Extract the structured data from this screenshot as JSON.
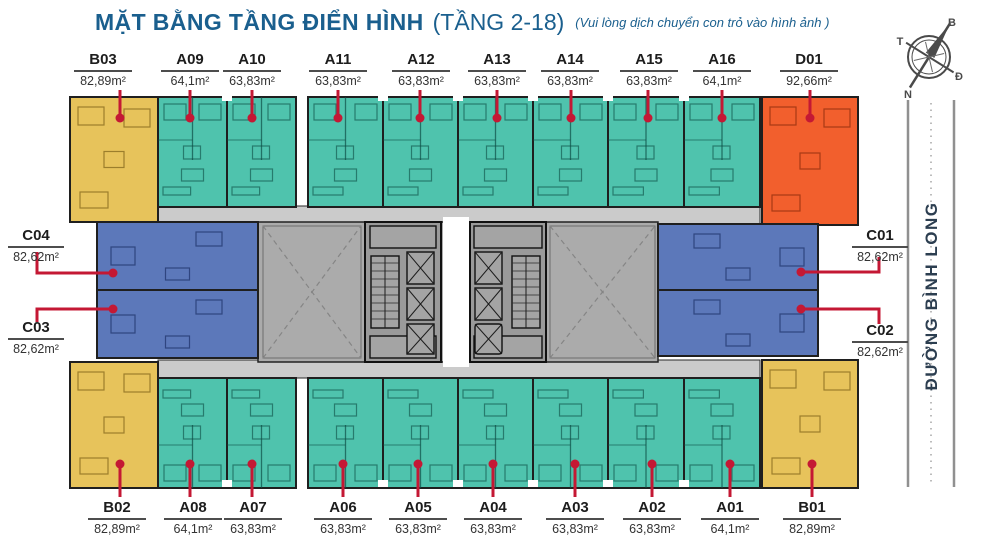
{
  "page": {
    "title": "MẶT BẰNG TẦNG ĐIỂN HÌNH",
    "title_suffix": "(TẦNG 2-18)",
    "note": "(Vui lòng dịch chuyển con trỏ vào hình ảnh )"
  },
  "street": {
    "name": "ĐƯỜNG BÌNH LONG"
  },
  "compass": {
    "north": "B",
    "south": "N",
    "east": "Đ",
    "west": "T"
  },
  "legend_colors": {
    "type_a": "#4FC3AD",
    "type_b": "#E7C35B",
    "type_c": "#5C78BA",
    "type_d": "#F25F2D",
    "corridor": "#CBCBCB",
    "core": "#9A9A9A",
    "void": "#ABABAB",
    "callout_red": "#C41834",
    "title_blue": "#1A5F8E",
    "street_text": "#2C3E50",
    "wall": "#1F1F1F"
  },
  "units": [
    {
      "id": "B03",
      "area": "82,89m²"
    },
    {
      "id": "A09",
      "area": "64,1m²"
    },
    {
      "id": "A10",
      "area": "63,83m²"
    },
    {
      "id": "A11",
      "area": "63,83m²"
    },
    {
      "id": "A12",
      "area": "63,83m²"
    },
    {
      "id": "A13",
      "area": "63,83m²"
    },
    {
      "id": "A14",
      "area": "63,83m²"
    },
    {
      "id": "A15",
      "area": "63,83m²"
    },
    {
      "id": "A16",
      "area": "64,1m²"
    },
    {
      "id": "D01",
      "area": "92,66m²"
    },
    {
      "id": "C04",
      "area": "82,62m²"
    },
    {
      "id": "C03",
      "area": "82,62m²"
    },
    {
      "id": "C01",
      "area": "82,62m²"
    },
    {
      "id": "C02",
      "area": "82,62m²"
    },
    {
      "id": "B02",
      "area": "82,89m²"
    },
    {
      "id": "A08",
      "area": "64,1m²"
    },
    {
      "id": "A07",
      "area": "63,83m²"
    },
    {
      "id": "A06",
      "area": "63,83m²"
    },
    {
      "id": "A05",
      "area": "63,83m²"
    },
    {
      "id": "A04",
      "area": "63,83m²"
    },
    {
      "id": "A03",
      "area": "63,83m²"
    },
    {
      "id": "A02",
      "area": "63,83m²"
    },
    {
      "id": "A01",
      "area": "64,1m²"
    },
    {
      "id": "B01",
      "area": "82,89m²"
    }
  ]
}
